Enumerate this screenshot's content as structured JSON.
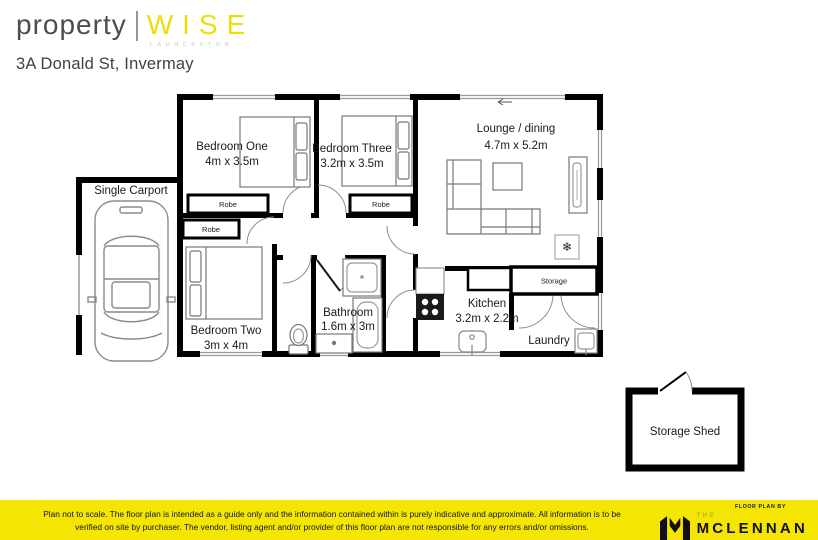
{
  "brand": {
    "name_left": "property",
    "name_right": "WISE",
    "tagline": "LAUNCESTON"
  },
  "address": "3A Donald St, Invermay",
  "floorplan": {
    "carport_label": "Single Carport",
    "rooms": {
      "bedroom_one": {
        "name": "Bedroom One",
        "dims": "4m x 3.5m"
      },
      "bedroom_three": {
        "name": "Bedroom Three",
        "dims": "3.2m x 3.5m"
      },
      "lounge": {
        "name": "Lounge / dining",
        "dims": "4.7m x 5.2m"
      },
      "bedroom_two": {
        "name": "Bedroom Two",
        "dims": "3m x 4m"
      },
      "bathroom": {
        "name": "Bathroom",
        "dims": "1.6m x 3m"
      },
      "kitchen": {
        "name": "Kitchen",
        "dims": "3.2m x 2.2m"
      },
      "laundry": {
        "name": "Laundry"
      }
    },
    "robe_label": "Robe",
    "storage_label": "Storage",
    "storage_shed_label": "Storage Shed"
  },
  "footer": {
    "disclaimer_line1": "Plan not to scale. The floor plan is intended as a guide only and the information contained within is purely indicative and approximate. All information is to be",
    "disclaimer_line2": "verified on site by purchaser. The vendor, listing agent and/or provider of this floor plan are not responsible for any errors and/or omissions.",
    "credit": "FLOOR PLAN BY",
    "agency_prefix": "THE",
    "agency_name": "MCLENNAN"
  },
  "colors": {
    "brand_yellow": "#F4E504",
    "text_dark": "#414042"
  }
}
